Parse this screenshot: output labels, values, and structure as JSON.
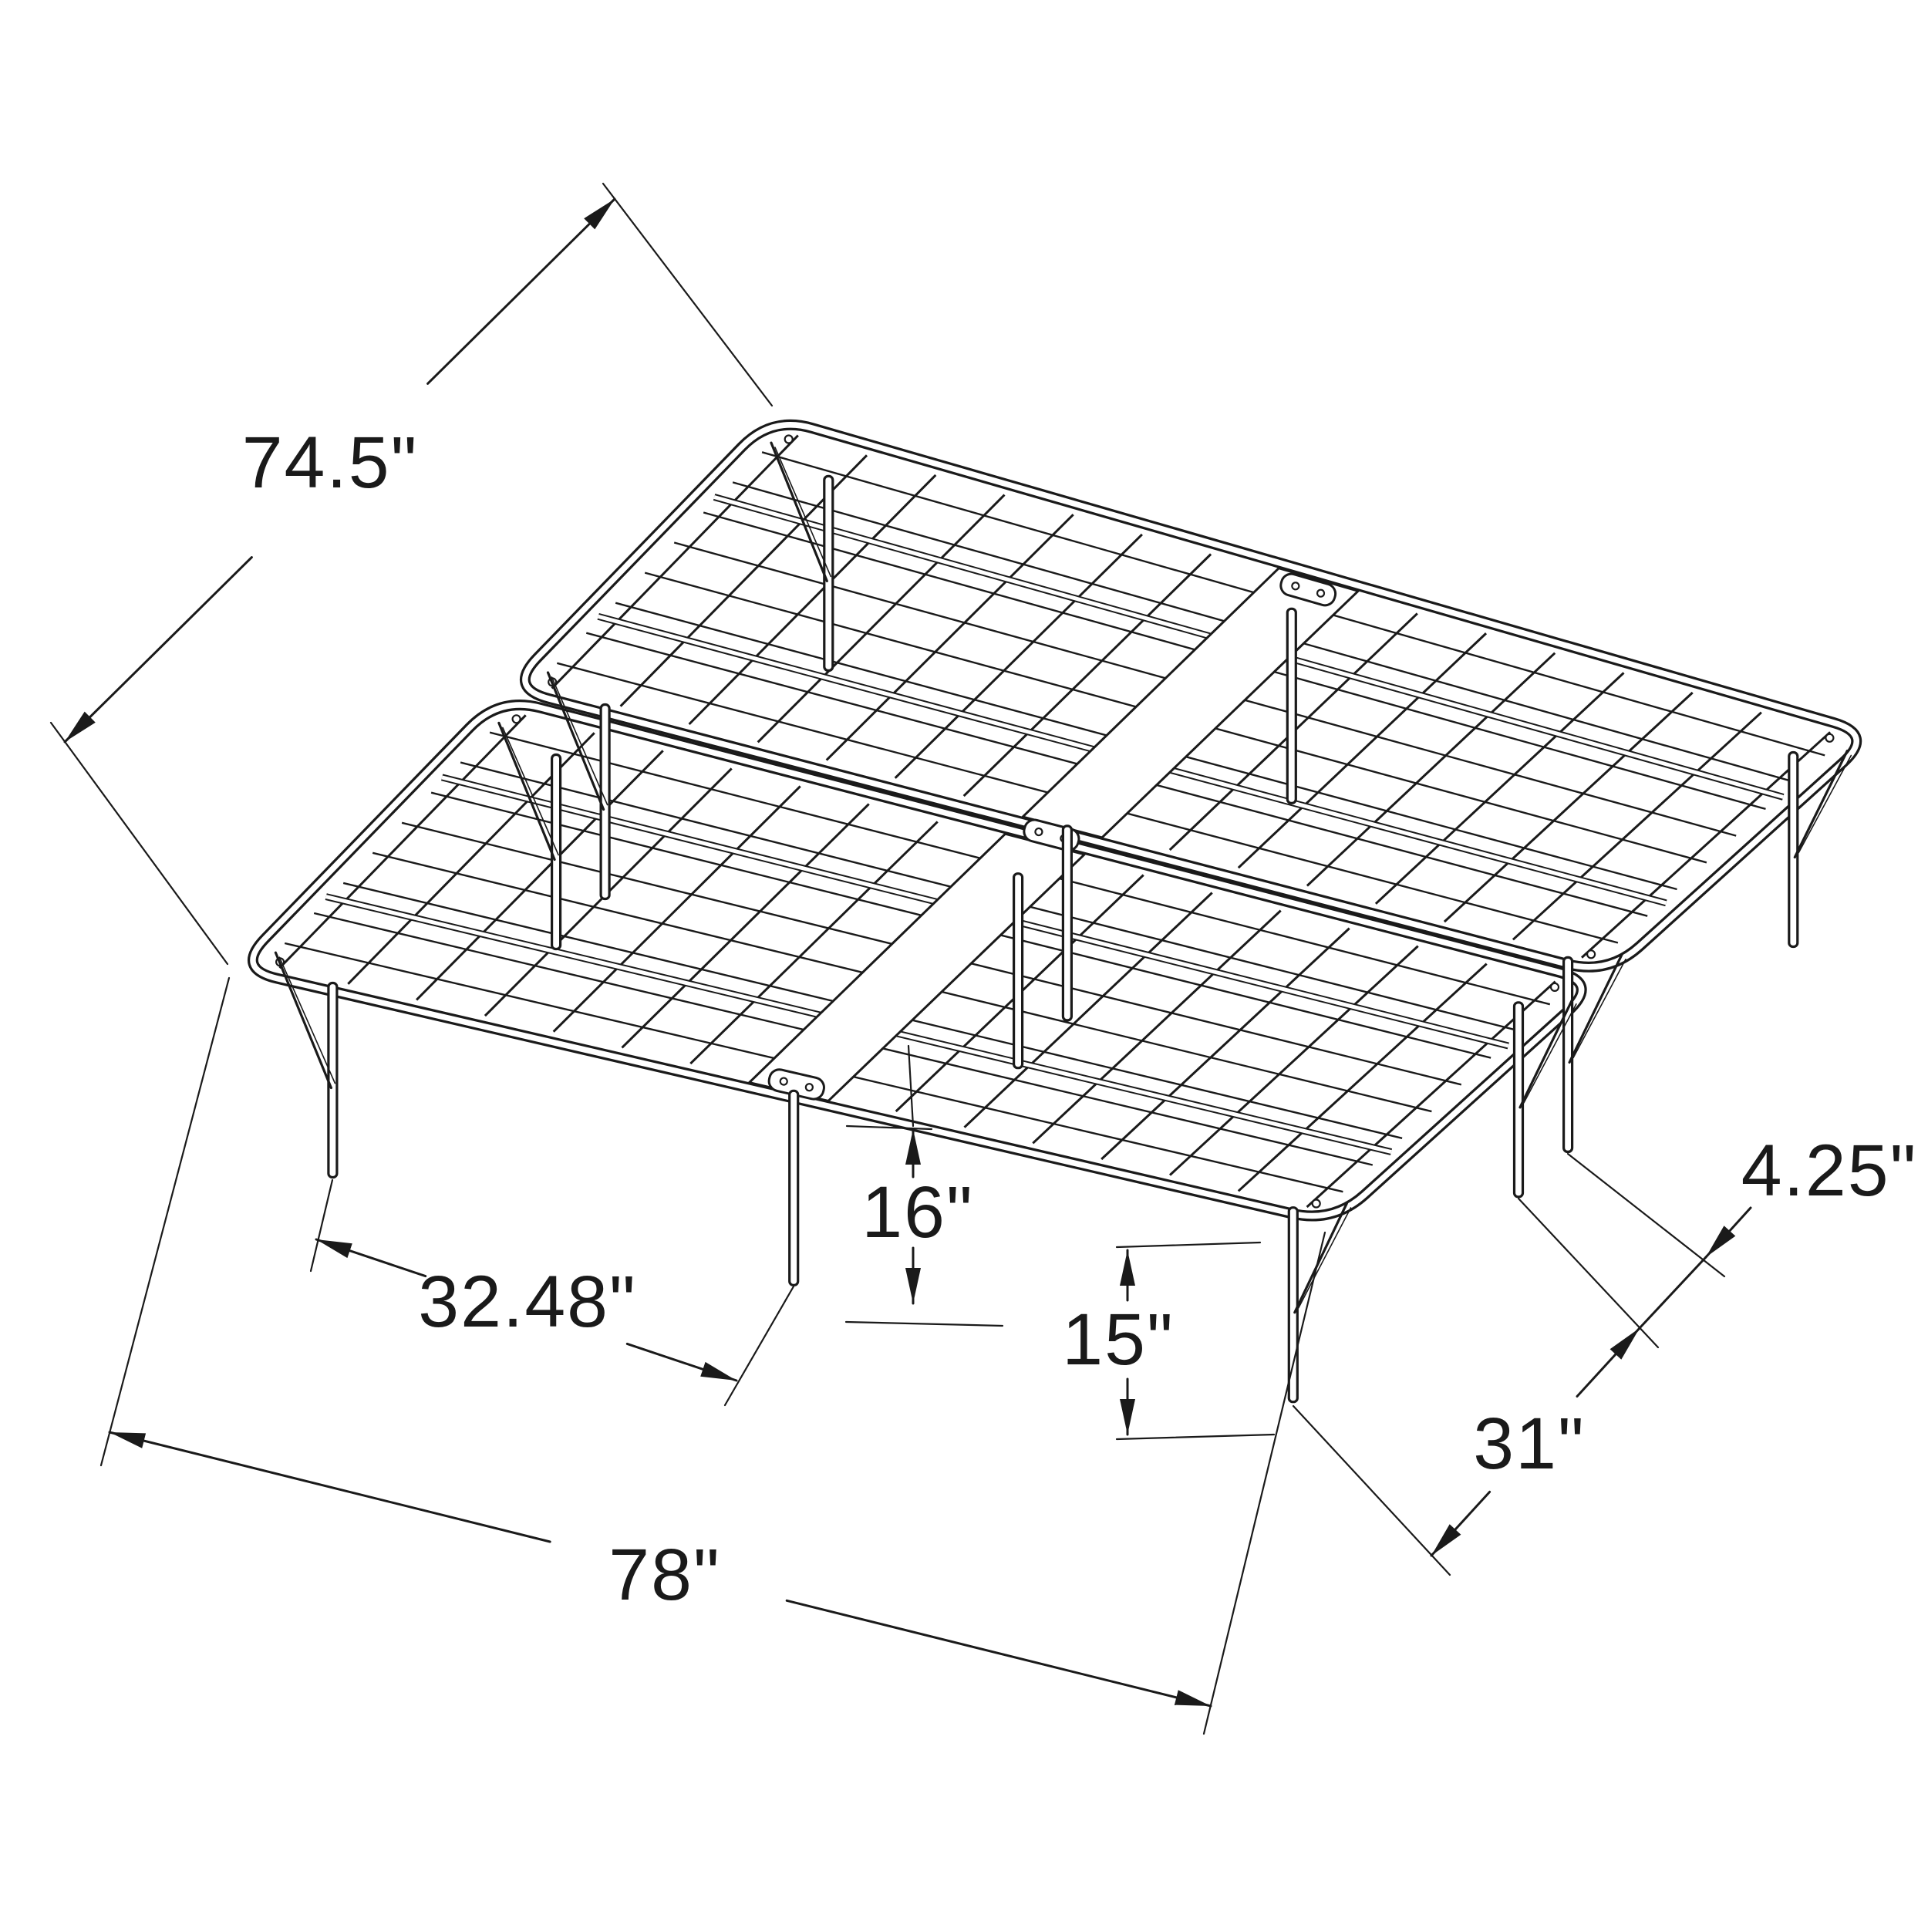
{
  "diagram": {
    "subject": "folding platform bed frame",
    "dimensions": {
      "frame_width": "74.5\"",
      "frame_length": "78\"",
      "leg_spacing": "32.48\"",
      "frame_height": "16\"",
      "under_clearance": "15\"",
      "side_leg_spacing": "31\"",
      "leg_pair_gap": "4.25\""
    },
    "colors": {
      "line": "#1a1a1a",
      "background": "#ffffff"
    }
  }
}
